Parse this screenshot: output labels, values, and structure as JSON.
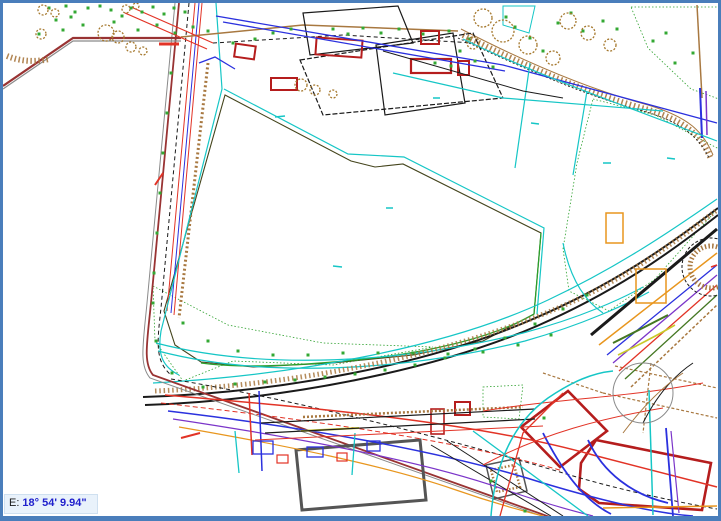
{
  "window": {
    "border_color": "#4a7ebb",
    "canvas_bg": "#ffffff"
  },
  "status_tooltip": {
    "label": "E:",
    "value": "18° 54' 9.94\"",
    "label_color": "#1a1a1a",
    "value_color": "#2020cc",
    "bg": "#e9f2fb"
  },
  "map_colors": {
    "parcel_fill": "#f7f6a2",
    "parcel_outline": "#44441c",
    "vegetation_dot": "#33a833",
    "vegetation_fill": "#eef5c6",
    "boundary_maroon": "#993333",
    "road_black": "#1a1a1a",
    "utility_red": "#e23326",
    "utility_blue": "#2b31de",
    "utility_purple": "#7b35c9",
    "utility_orange": "#e8961e",
    "utility_cyan": "#16c6c6",
    "contour_brown": "#a87840",
    "tree_brown": "#a5782d",
    "building_red_stroke": "#b51d1d",
    "building_pink_fill": "#f6dcdc",
    "building_gray": "#555555",
    "field_green": "#2ca02c",
    "shadow_gray": "#8a8a8a",
    "olive_line": "#c9c92a",
    "dark_green": "#447722"
  }
}
